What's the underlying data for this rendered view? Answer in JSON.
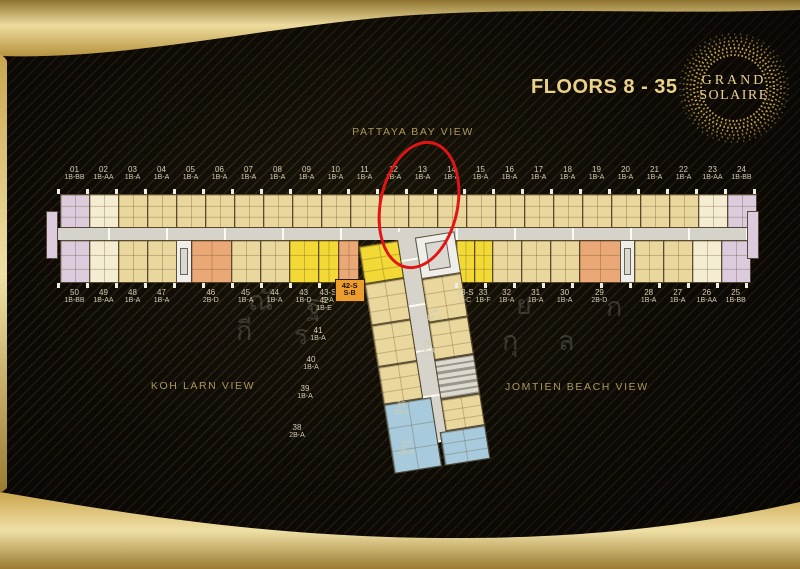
{
  "header": {
    "floors_label": "FLOORS 8 - 35",
    "logo": {
      "line1": "GRAND",
      "line2": "SOLAIRE"
    }
  },
  "views": {
    "top": "PATTAYA BAY VIEW",
    "bottom_left": "KOH LARN VIEW",
    "bottom_right": "JOMTIEN BEACH VIEW"
  },
  "annotation": {
    "shape": "red-ellipse",
    "circled_units": "12, 13"
  },
  "watermark": {
    "glyphs": [
      "ณั",
      "ฐ",
      "ย",
      "ก",
      "กี",
      "ร",
      "ร",
      "กุ",
      "ล",
      "ส"
    ]
  },
  "colors": {
    "gold": "#d9bd72",
    "unit_standard": "#ead79e",
    "unit_end_cream": "#f4edd2",
    "unit_corner_lavender": "#dbcbdc",
    "unit_2bd_orange": "#eaa877",
    "unit_special_yellow": "#f2d935",
    "unit_2ba_blue": "#a7cbdd",
    "corridor": "#d6d3ca",
    "core_white": "#f0eee8",
    "highlight_red": "#e21414"
  },
  "floorplan": {
    "top_units": [
      {
        "no": "01",
        "type": "1B-BB",
        "c": "lav"
      },
      {
        "no": "02",
        "type": "1B-AA",
        "c": "cream"
      },
      {
        "no": "03",
        "type": "1B-A",
        "c": "std"
      },
      {
        "no": "04",
        "type": "1B-A",
        "c": "std"
      },
      {
        "no": "05",
        "type": "1B-A",
        "c": "std"
      },
      {
        "no": "06",
        "type": "1B-A",
        "c": "std"
      },
      {
        "no": "07",
        "type": "1B-A",
        "c": "std"
      },
      {
        "no": "08",
        "type": "1B-A",
        "c": "std"
      },
      {
        "no": "09",
        "type": "1B-A",
        "c": "std"
      },
      {
        "no": "10",
        "type": "1B-A",
        "c": "std"
      },
      {
        "no": "11",
        "type": "1B-A",
        "c": "std"
      },
      {
        "no": "12",
        "type": "1B-A",
        "c": "std"
      },
      {
        "no": "13",
        "type": "1B-A",
        "c": "std"
      },
      {
        "no": "14",
        "type": "1B-A",
        "c": "std"
      },
      {
        "no": "15",
        "type": "1B-A",
        "c": "std"
      },
      {
        "no": "16",
        "type": "1B-A",
        "c": "std"
      },
      {
        "no": "17",
        "type": "1B-A",
        "c": "std"
      },
      {
        "no": "18",
        "type": "1B-A",
        "c": "std"
      },
      {
        "no": "19",
        "type": "1B-A",
        "c": "std"
      },
      {
        "no": "20",
        "type": "1B-A",
        "c": "std"
      },
      {
        "no": "21",
        "type": "1B-A",
        "c": "std"
      },
      {
        "no": "22",
        "type": "1B-A",
        "c": "std"
      },
      {
        "no": "23",
        "type": "1B-AA",
        "c": "cream"
      },
      {
        "no": "24",
        "type": "1B-BB",
        "c": "lav"
      }
    ],
    "bottom_units": [
      {
        "no": "50",
        "type": "1B-BB",
        "c": "lav"
      },
      {
        "no": "49",
        "type": "1B-AA",
        "c": "cream"
      },
      {
        "no": "48",
        "type": "1B-A",
        "c": "std"
      },
      {
        "no": "47",
        "type": "1B-A",
        "c": "std"
      },
      {
        "k": "core",
        "w": 0.5
      },
      {
        "no": "46",
        "type": "2B-D",
        "c": "org",
        "w": 1.4
      },
      {
        "no": "45",
        "type": "1B-A",
        "c": "std"
      },
      {
        "no": "44",
        "type": "1B-A",
        "c": "std"
      },
      {
        "no": "43",
        "type": "1B-D",
        "c": "spec"
      },
      {
        "no": "43-S",
        "type": "S-A",
        "c": "spec",
        "w": 0.68
      },
      {
        "no": "42-S",
        "type": "S-B",
        "c": "org",
        "w": 0.68,
        "box": true
      },
      {
        "k": "gap",
        "w": 3.4
      },
      {
        "no": "33-S",
        "type": "S-C",
        "c": "spec",
        "w": 0.62
      },
      {
        "no": "33",
        "type": "1B-F",
        "c": "spec",
        "w": 0.62
      },
      {
        "no": "32",
        "type": "1B-A",
        "c": "std"
      },
      {
        "no": "31",
        "type": "1B-A",
        "c": "std"
      },
      {
        "no": "30",
        "type": "1B-A",
        "c": "std"
      },
      {
        "no": "29",
        "type": "2B-D",
        "c": "org",
        "w": 1.4
      },
      {
        "k": "core",
        "w": 0.5
      },
      {
        "no": "28",
        "type": "1B-A",
        "c": "std"
      },
      {
        "no": "27",
        "type": "1B-A",
        "c": "std"
      },
      {
        "no": "26",
        "type": "1B-AA",
        "c": "cream"
      },
      {
        "no": "25",
        "type": "1B-BB",
        "c": "lav"
      }
    ],
    "stem": {
      "left_units": [
        {
          "no": "42",
          "type": "1B-E",
          "c": "spec"
        },
        {
          "no": "41",
          "type": "1B-A",
          "c": "std"
        },
        {
          "no": "40",
          "type": "1B-A",
          "c": "std"
        },
        {
          "no": "39",
          "type": "1B-A",
          "c": "std"
        },
        {
          "no": "38",
          "type": "2B-A",
          "c": "blue"
        }
      ],
      "right_units": [
        {
          "no": "34",
          "type": "1B-A",
          "c": "std"
        },
        {
          "no": "35",
          "type": "1B-A",
          "c": "std"
        },
        {
          "no": "36",
          "type": "1B-A",
          "c": "std"
        },
        {
          "no": "37",
          "type": "2B-A",
          "c": "blue"
        }
      ]
    }
  }
}
